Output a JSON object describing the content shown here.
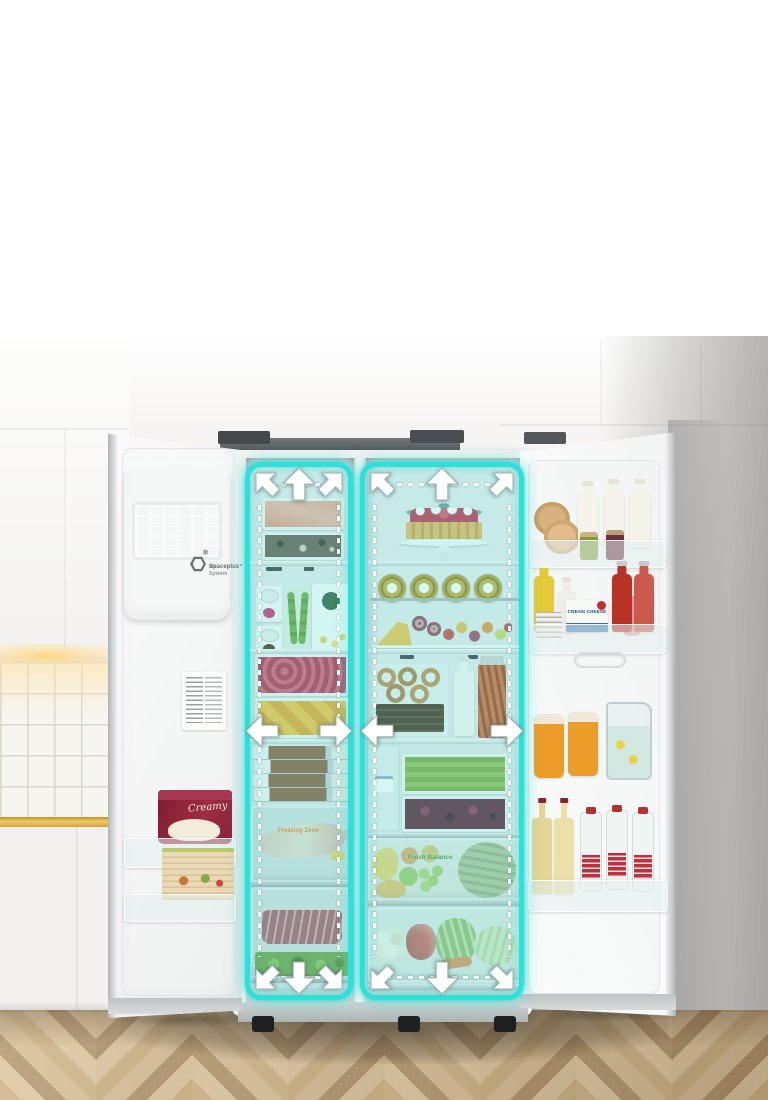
{
  "overlay": {
    "accent_color": "#2EE0DA",
    "dash_color": "#FFFFFF",
    "zones": [
      {
        "id": "freezer-space-zone",
        "arrow_directions": [
          "up-left",
          "up",
          "up-right",
          "left",
          "right",
          "down-left",
          "down",
          "down-right"
        ]
      },
      {
        "id": "fresh-food-space-zone",
        "arrow_directions": [
          "up-left",
          "up",
          "up-right",
          "left",
          "right",
          "down-left",
          "down",
          "down-right"
        ]
      }
    ]
  },
  "fridge": {
    "left_door": {
      "logo_line1": "Spaceplus™",
      "logo_line2": "Ice System",
      "ice_cream_tub_label": "Creamy"
    },
    "freezer_column": {
      "bottom_drawer_label": "Freezing Zone"
    },
    "fresh_column": {
      "fruit_drawer_label": "Fresh Balance"
    },
    "right_door": {
      "cream_cheese_box_label": "CREAM CHEESE"
    }
  },
  "palette": {
    "accent_teal": "#2EE0DA",
    "backsplash_stripe_gold": "#E8BE55",
    "wood_floor_tan": "#CBB084",
    "wall_gray": "#E7E6E5",
    "fridge_white": "#F2F3F3"
  }
}
